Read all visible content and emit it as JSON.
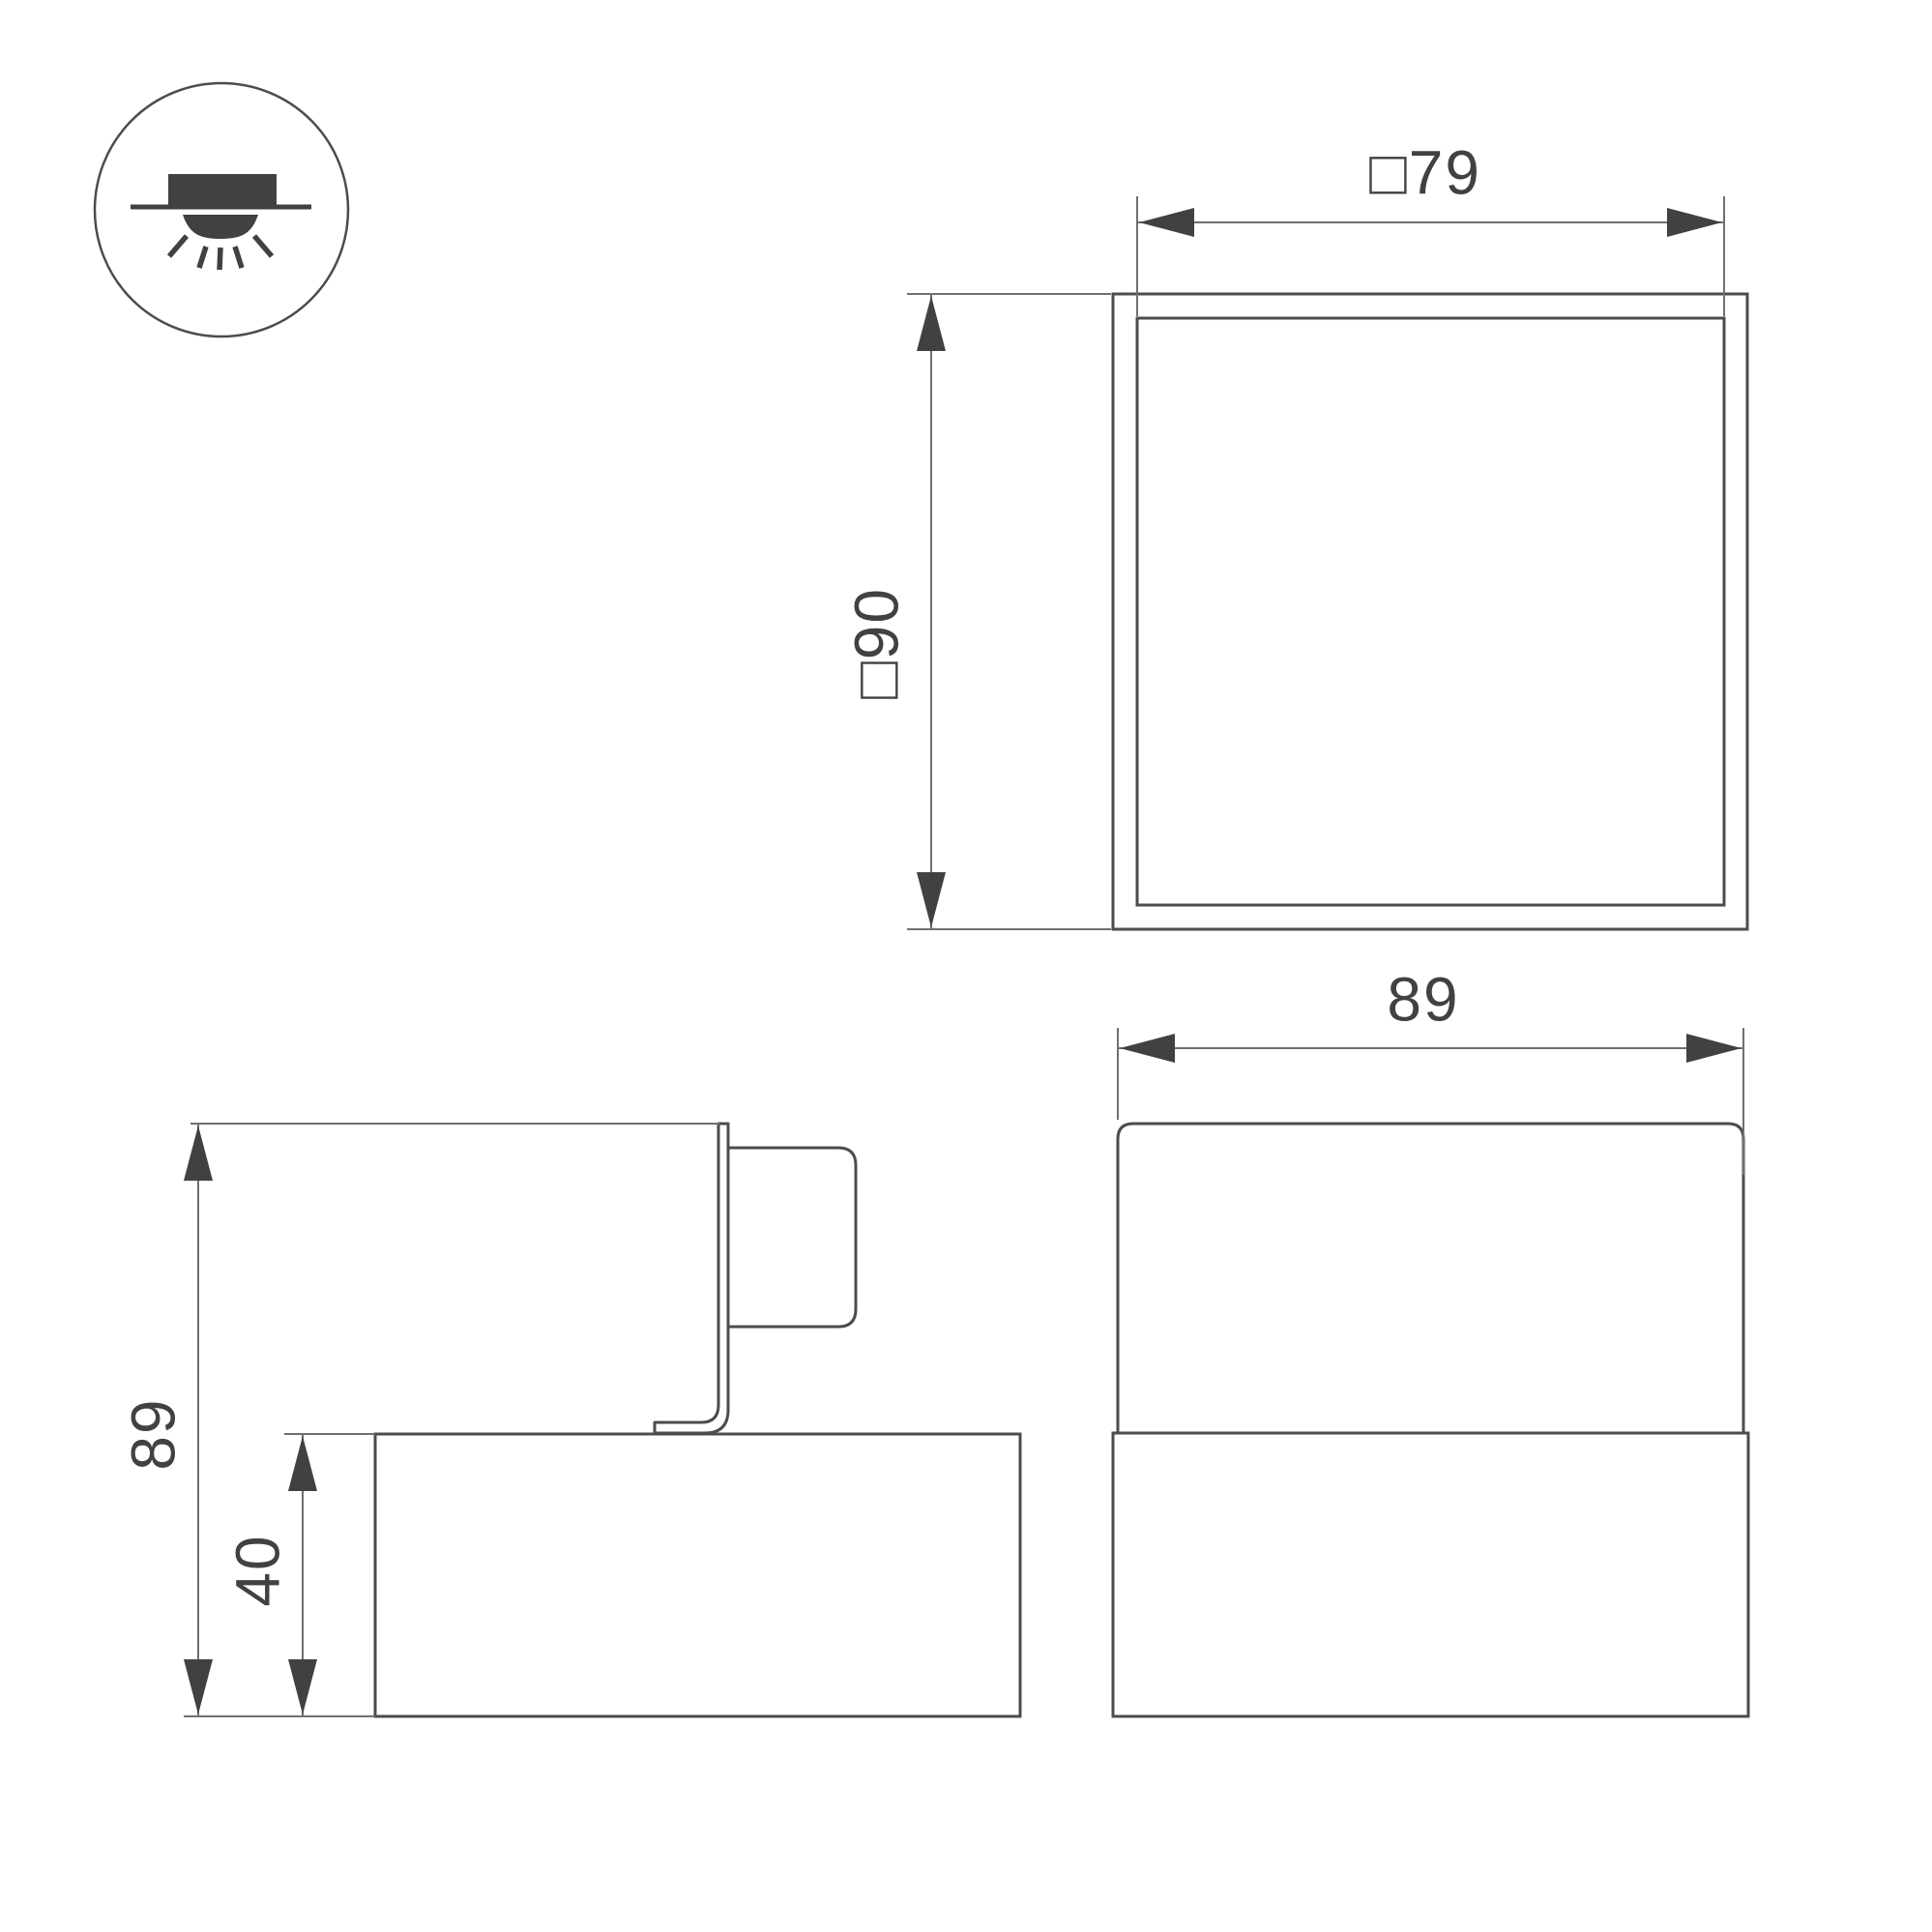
{
  "drawing": {
    "kind": "technical-dimension-drawing",
    "subject": "surface-mounted cube luminaire",
    "background": "#ffffff",
    "colors": {
      "object_line": "#4c4c4e",
      "dimension_line": "#707072",
      "arrow_and_text": "#414143"
    },
    "icon": {
      "name": "surface-mount-downlight-icon"
    },
    "dimensions": {
      "top_view": {
        "width_label": "□79",
        "height_label": "□90"
      },
      "front_view": {
        "width_label": "89"
      },
      "side_view": {
        "total_height_label": "89",
        "base_height_label": "40"
      }
    }
  }
}
